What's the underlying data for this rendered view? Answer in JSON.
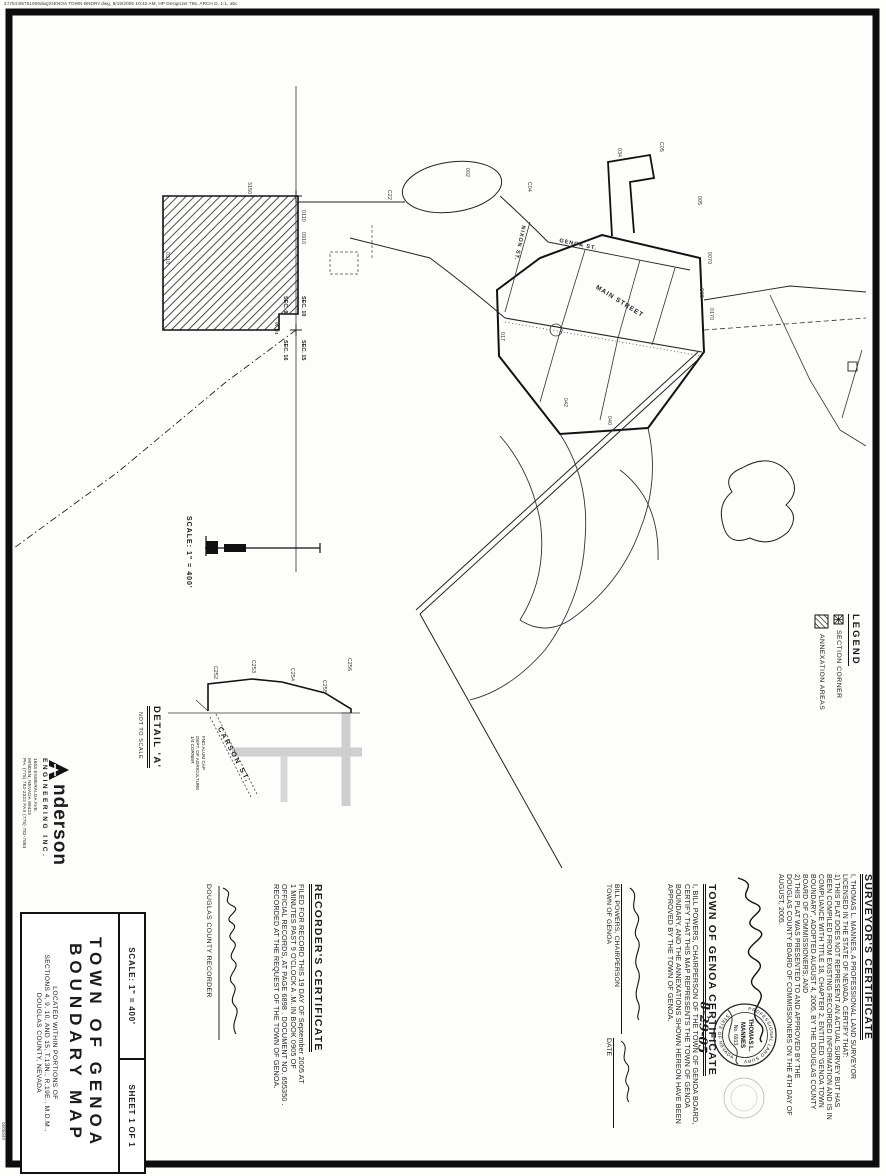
{
  "page": {
    "plot_line": "2:\\751\\05751006dwg\\GENOA TOWN BNDRY.dwg, 9/19/2005 10:42 AM, HP DesignJet 755, ARCH D, 1:1, abc",
    "side_number": "0605049"
  },
  "legend": {
    "title": "LEGEND",
    "items": [
      {
        "symbol": "section-corner",
        "label": "SECTION CORNER"
      },
      {
        "symbol": "annexation-hatch",
        "label": "ANNEXATION AREAS"
      }
    ]
  },
  "map": {
    "scale_label": "SCALE: 1\" = 400'",
    "detail_title": "DETAIL 'A'",
    "detail_scale": "NOT TO SCALE",
    "streets": {
      "main": "MAIN STREET",
      "genoa": "GENOA ST.",
      "nixon": "NIXON ST.",
      "carson": "CARSON ST."
    },
    "sections": [
      "SEC. 9",
      "SEC. 10",
      "SEC. 16",
      "SEC. 15",
      "W 1/4"
    ],
    "tags": [
      "3150",
      "0110",
      "0910",
      "0310",
      "C22",
      "002",
      "C04",
      "034",
      "C05",
      "005",
      "0070",
      "C09",
      "0170",
      "017",
      "042",
      "040"
    ],
    "detail_courses": [
      "C252",
      "C253",
      "C254",
      "C255",
      "C256"
    ],
    "detail_note_lines": [
      "FND ALUM CAP",
      "DEPT. OF AGRICULTURE",
      "1/4 CORNER"
    ]
  },
  "recorder_certificate": {
    "title": "RECORDER'S CERTIFICATE",
    "lines": [
      "FILED FOR RECORD THIS  19  DAY OF  September  2005  AT",
      " 1  MINUTES PAST  9  O'CLOCK  A .M. IN BOOK  0905  OF",
      "OFFICIAL RECORDS, AT PAGE  6898 . DOCUMENT NO.  655350 .",
      "RECORDED AT THE REQUEST OF THE TOWN OF GENOA."
    ],
    "recorder_label": "DOUGLAS COUNTY RECORDER"
  },
  "town_certificate": {
    "title": "TOWN OF GENOA CERTIFICATE",
    "lines": [
      "I, BILL POWERS, CHAIRPERSON OF THE TOWN OF GENOA BOARD,",
      "CERTIFY THAT THIS MAP REPRESENTS THE TOWN OF GENOA",
      "BOUNDARY, AND THE ANNEXATIONS SHOWN HEREON HAVE BEEN",
      "APPROVED BY THE TOWN OF GENOA."
    ],
    "signer_line1": "BILL POWERS, CHAIRPERSON",
    "signer_line2": "TOWN OF GENOA",
    "date_label": "DATE",
    "date_value": "8-29-05"
  },
  "surveyor_certificate": {
    "title": "SURVEYOR'S CERTIFICATE",
    "lines": [
      "I, THOMAS L. MANNES, A PROFESSIONAL LAND SURVEYOR",
      "LICENSED IN THE STATE OF NEVADA, CERTIFY THAT:",
      "1)  THIS PLAT DOES NOT REPRESENT AN ACTUAL SURVEY BUT HAS",
      "BEEN COMPILED FROM EXISTING RECORDED INFORMATION AND IS IN",
      "COMPLIANCE WITH TITLE 18, CHAPTER 2, ENTITLED 'GENOA TOWN",
      "BOUNDARY', ADOPTED AUGUST 4, 2005, BY THE DOUGLAS COUNTY",
      "BOARD OF COMMISSIONERS; AND",
      "2)  THIS PLAT WAS PRESENTED TO AND APPROVED BY THE",
      "DOUGLAS COUNTY BOARD OF COMMISSIONERS ON THE 4TH DAY OF",
      "AUGUST, 2005."
    ]
  },
  "stamp": {
    "arc_top": "PROFESSIONAL LAND SURVEYOR",
    "arc_bottom": "STATE OF NEVADA",
    "name_line1": "THOMAS L.",
    "name_line2": "MANNES",
    "number": "No. 6913"
  },
  "firm": {
    "name_rest": "nderson",
    "tagline": "ENGINEERING INC.",
    "address_lines": [
      "1603 ESMERALDA AVE.",
      "MINDEN, NEVADA 89423",
      "PH. (775) 782-2322   FAX (775) 782-7084"
    ]
  },
  "title_block": {
    "title_line1": "TOWN OF GENOA",
    "title_line2": "BOUNDARY MAP",
    "subtitle_line1": "LOCATED WITHIN PORTIONS OF",
    "subtitle_line2": "SECTIONS 4, 9, 10, AND 15, T.13N., R.19E., M.D.M.,",
    "subtitle_line3": "DOUGLAS COUNTY, NEVADA",
    "scale": "SCALE: 1\" = 400'",
    "sheet": "SHEET 1 OF 1"
  }
}
